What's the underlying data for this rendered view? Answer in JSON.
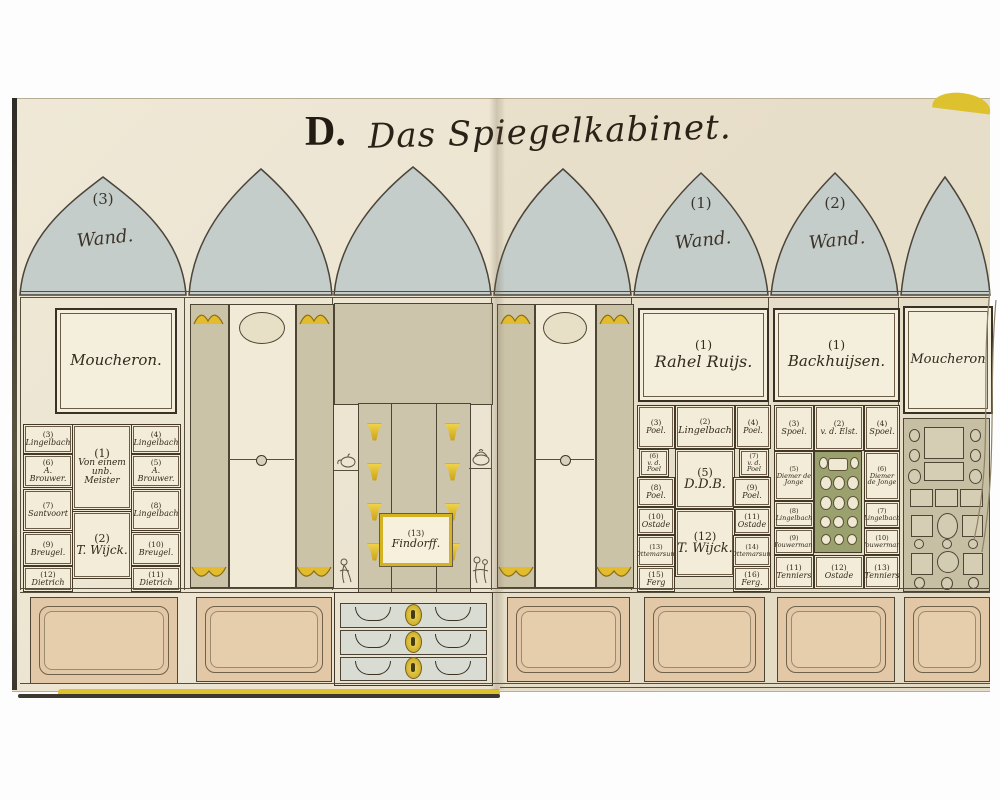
{
  "title": {
    "prefix": "D.",
    "script": "Das Spiegelkabinet."
  },
  "colors": {
    "page": "#ece4d1",
    "arch_blue": "#c5cdca",
    "olive": "#ccc5ab",
    "gold": "#d8b722",
    "dado_tan": "#e2c8a6",
    "ink": "#33291c",
    "cover_yellow": "#ddc12f"
  },
  "arches": [
    {
      "number": "(3)",
      "label": "Wand."
    },
    {
      "number": "",
      "label": ""
    },
    {
      "number": "",
      "label": ""
    },
    {
      "number": "",
      "label": ""
    },
    {
      "number": "(1)",
      "label": "Wand."
    },
    {
      "number": "(2)",
      "label": "Wand."
    },
    {
      "number": "",
      "label": ""
    }
  ],
  "wall3": {
    "main_painting": "Moucheron.",
    "center_top": {
      "number": "(1)",
      "name": "Von einem unb. Meister"
    },
    "center_bottom": {
      "number": "(2)",
      "name": "T. Wijck."
    },
    "left_column": [
      {
        "number": "(3)",
        "name": "Lingelbach"
      },
      {
        "number": "(6)",
        "name": "A. Brouwer."
      },
      {
        "number": "(7)",
        "name": "Santvoort"
      },
      {
        "number": "(9)",
        "name": "Breugel."
      },
      {
        "number": "(12)",
        "name": "Dietrich"
      }
    ],
    "right_column": [
      {
        "number": "(4)",
        "name": "Lingelbach"
      },
      {
        "number": "(5)",
        "name": "A. Brouwer."
      },
      {
        "number": "(8)",
        "name": "Lingelbach"
      },
      {
        "number": "(10)",
        "name": "Breugel."
      },
      {
        "number": "(11)",
        "name": "Dietrich"
      }
    ]
  },
  "cabinet": {
    "label": {
      "number": "(13)",
      "name": "Findorff."
    }
  },
  "wall1": {
    "main": {
      "number": "(1)",
      "name": "Rahel Ruijs."
    },
    "row1": [
      {
        "number": "(3)",
        "name": "Poel."
      },
      {
        "number": "(2)",
        "name": "Lingelbach"
      },
      {
        "number": "(4)",
        "name": "Poel."
      }
    ],
    "tiny_left": {
      "number": "(6)",
      "name": "v. d. Poel"
    },
    "tiny_right": {
      "number": "(7)",
      "name": "v. d. Poel"
    },
    "center_mid": {
      "number": "(5)",
      "name": "D.D.B."
    },
    "row3": [
      {
        "number": "(8)",
        "name": "Poel."
      },
      {
        "number": "(9)",
        "name": "Poel."
      }
    ],
    "row4": [
      {
        "number": "(10)",
        "name": "Ostade"
      },
      {
        "number": "(11)",
        "name": "Ostade"
      }
    ],
    "center_low": {
      "number": "(12)",
      "name": "T. Wijck."
    },
    "row5": [
      {
        "number": "(13)",
        "name": "Ottemarsum"
      },
      {
        "number": "(14)",
        "name": "Ottemarsum"
      }
    ],
    "row6": [
      {
        "number": "(15)",
        "name": "Ferg"
      },
      {
        "number": "(16)",
        "name": "Ferg."
      }
    ]
  },
  "wall2": {
    "main": {
      "number": "(1)",
      "name": "Backhuijsen."
    },
    "row1": [
      {
        "number": "(3)",
        "name": "Spoel."
      },
      {
        "number": "(2)",
        "name": "v. d. Elst."
      },
      {
        "number": "(4)",
        "name": "Spoel."
      }
    ],
    "row2": [
      {
        "number": "(5)",
        "name": "Diemer de Jonge"
      },
      {
        "number": "(6)",
        "name": "Diemer de Jonge"
      }
    ],
    "row3": [
      {
        "number": "(8)",
        "name": "Lingelbach"
      },
      {
        "number": "(7)",
        "name": "Lingelbach"
      }
    ],
    "row4": [
      {
        "number": "(9)",
        "name": "Wouwermann"
      },
      {
        "number": "(10)",
        "name": "Wouwermann"
      }
    ],
    "row5": [
      {
        "number": "(11)",
        "name": "Tenniers"
      },
      {
        "number": "(12)",
        "name": "Ostade"
      },
      {
        "number": "(13)",
        "name": "Tenniers"
      }
    ]
  },
  "wall_right": {
    "main_painting": "Moucheron"
  }
}
